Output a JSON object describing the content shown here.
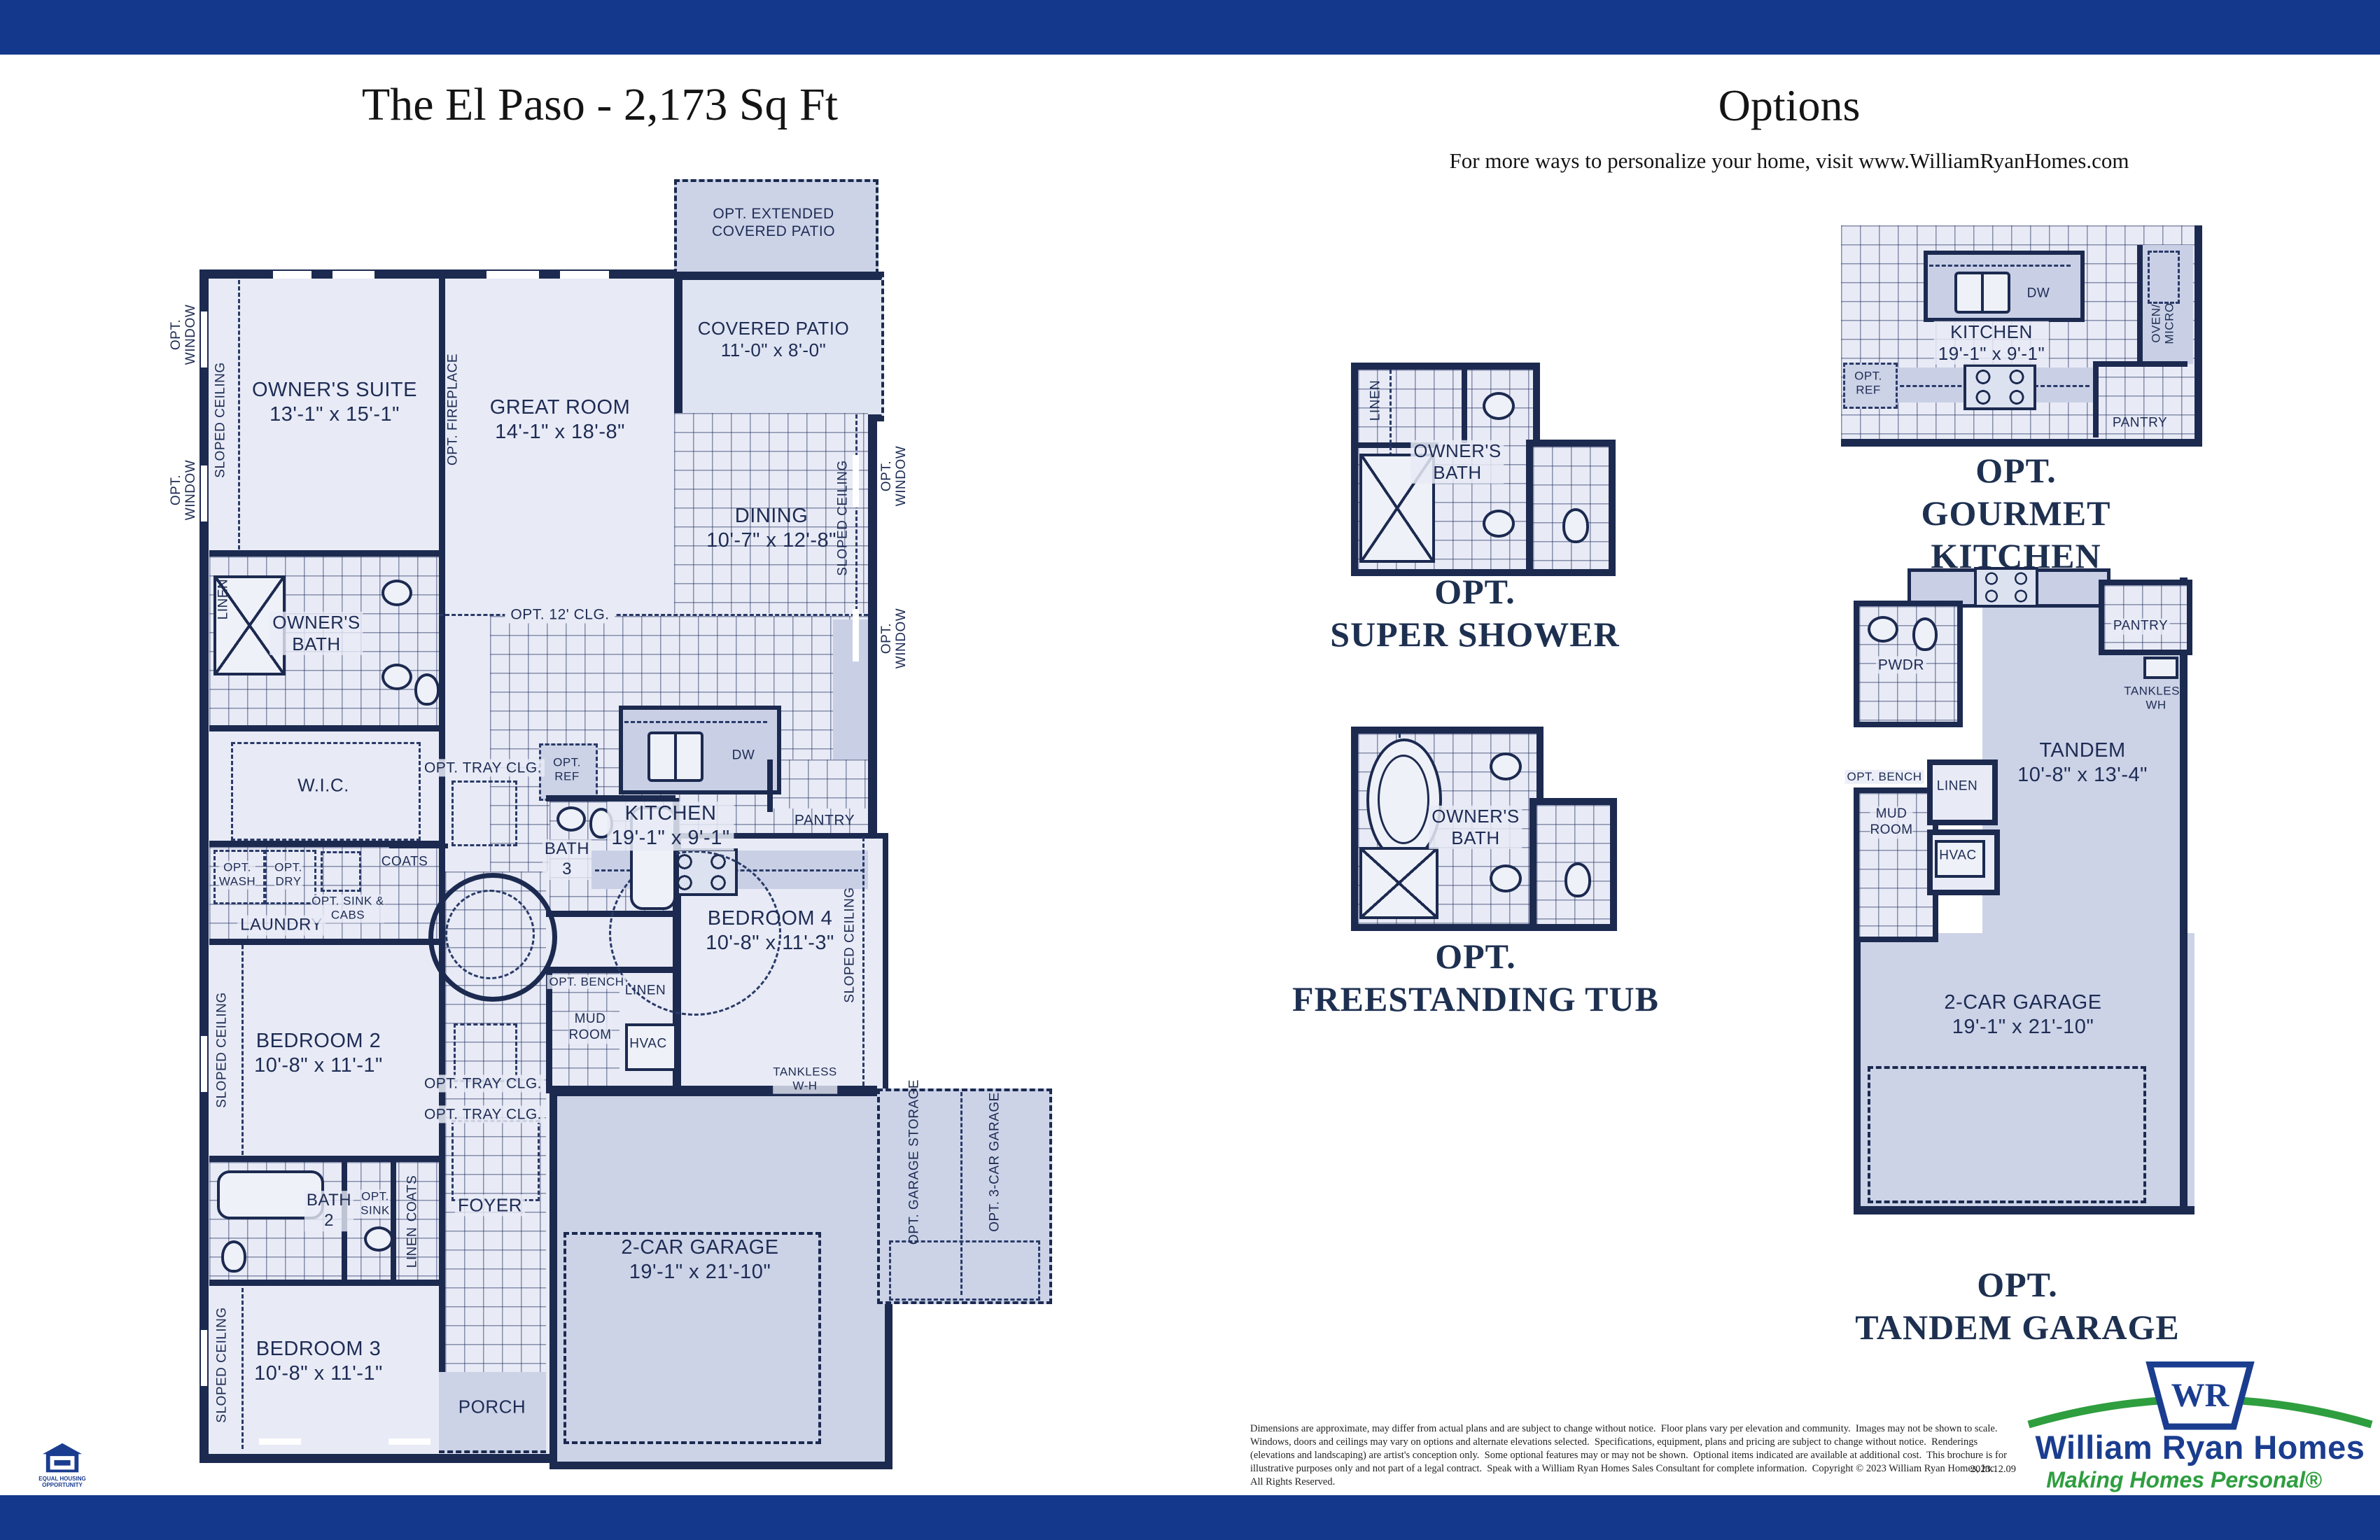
{
  "page": {
    "left_title": "The El Paso - 2,173 Sq Ft",
    "right_title": "Options",
    "right_subtitle": "For more ways to personalize your home, visit www.WilliamRyanHomes.com"
  },
  "plan": {
    "opt_extended_patio": "OPT. EXTENDED\nCOVERED PATIO",
    "covered_patio": "COVERED PATIO\n11'-0\" x 8'-0\"",
    "owners_suite": "OWNER'S SUITE\n13'-1\" x 15'-1\"",
    "great_room": "GREAT ROOM\n14'-1\" x 18'-8\"",
    "dining": "DINING\n10'-7\" x 12'-8\"",
    "kitchen": "KITCHEN\n19'-1\" x 9'-1\"",
    "owners_bath": "OWNER'S\nBATH",
    "wic": "W.I.C.",
    "laundry": "LAUNDRY",
    "bedroom2": "BEDROOM 2\n10'-8\" x 11'-1\"",
    "bedroom3": "BEDROOM 3\n10'-8\" x 11'-1\"",
    "bedroom4": "BEDROOM 4\n10'-8\" x 11'-3\"",
    "bath2": "BATH\n2",
    "bath3": "BATH\n3",
    "foyer": "FOYER",
    "porch": "PORCH",
    "garage": "2-CAR GARAGE\n19'-1\" x 21'-10\"",
    "pantry": "PANTRY",
    "coats": "COATS",
    "mud_room": "MUD\nROOM",
    "hvac": "HVAC",
    "linen": "LINEN",
    "tankless": "TANKLESS\nW-H",
    "opt_window": "OPT.\nWINDOW",
    "sloped_ceiling": "SLOPED CEILING",
    "opt_fireplace": "OPT. FIREPLACE",
    "opt_12_clg": "OPT. 12' CLG.",
    "opt_tray_clg": "OPT. TRAY CLG.",
    "opt_ref": "OPT.\nREF",
    "opt_wash": "OPT.\nWASH",
    "opt_dry": "OPT.\nDRY",
    "opt_sink_cabs": "OPT. SINK &\nCABS",
    "opt_sink": "OPT.\nSINK",
    "opt_bench": "OPT. BENCH",
    "dw": "DW",
    "opt_garage_storage": "OPT. GARAGE STORAGE",
    "opt_3car_garage": "OPT. 3-CAR GARAGE"
  },
  "options": {
    "super_shower": {
      "caption": "OPT.\nSUPER SHOWER",
      "owners_bath": "OWNER'S\nBATH",
      "linen": "LINEN"
    },
    "freestanding_tub": {
      "caption": "OPT.\nFREESTANDING TUB",
      "owners_bath": "OWNER'S\nBATH"
    },
    "gourmet_kitchen": {
      "caption": "OPT.\nGOURMET KITCHEN",
      "kitchen": "KITCHEN\n19'-1\" x 9'-1\"",
      "dw": "DW",
      "opt_ref": "OPT.\nREF",
      "oven_micro": "OVEN/\nMICRO",
      "pantry": "PANTRY"
    },
    "tandem_garage": {
      "caption": "OPT.\nTANDEM GARAGE",
      "pwdr": "PWDR",
      "pantry": "PANTRY",
      "tankless": "TANKLESS\nWH",
      "tandem": "TANDEM\n10'-8\" x 13'-4\"",
      "opt_bench": "OPT. BENCH",
      "mud_room": "MUD\nROOM",
      "linen": "LINEN",
      "hvac": "HVAC",
      "garage": "2-CAR GARAGE\n19'-1\" x 21'-10\""
    }
  },
  "footer": {
    "disclaimer": "Dimensions are approximate, may differ from actual plans and are subject to change without notice.  Floor plans vary per elevation and community.  Images may not be shown to scale.  Windows, doors and ceilings may vary on options and alternate elevations selected.  Specifications, equipment, plans and pricing are subject to change without notice.  Renderings (elevations and landscaping) are artist's conception only.  Some optional features may or may not be shown.  Optional items indicated are available at additional cost.  This brochure is for illustrative purposes only and not part of a legal contract.  Speak with a William Ryan Homes Sales Consultant for complete information.  Copyright © 2023 William Ryan Homes, Inc.  All Rights Reserved.",
    "date": "2023.12.09",
    "equal_housing": "EQUAL HOUSING\nOPPORTUNITY"
  },
  "logo": {
    "monogram": "WR",
    "name": "William Ryan Homes",
    "tagline": "Making Homes Personal®"
  }
}
